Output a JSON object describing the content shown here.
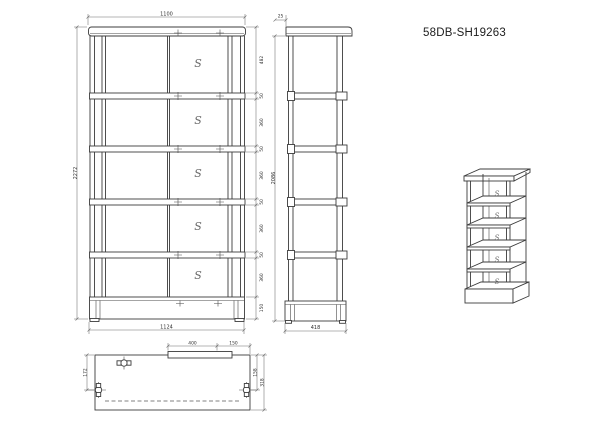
{
  "title": "58DB-SH19263",
  "s_mark": "S",
  "front_view": {
    "width_top": "1100",
    "width_bottom": "1124",
    "height_total": "2272",
    "chain": [
      "482",
      "50",
      "360",
      "50",
      "360",
      "50",
      "360",
      "50",
      "360",
      "150"
    ]
  },
  "side_view": {
    "height": "2086",
    "depth": "418",
    "top_offset": "25"
  },
  "plan_view": {
    "rail_width": "400",
    "rail_offset": "150",
    "left_offset": "172",
    "right_inner": "158",
    "right_outer": "318"
  }
}
